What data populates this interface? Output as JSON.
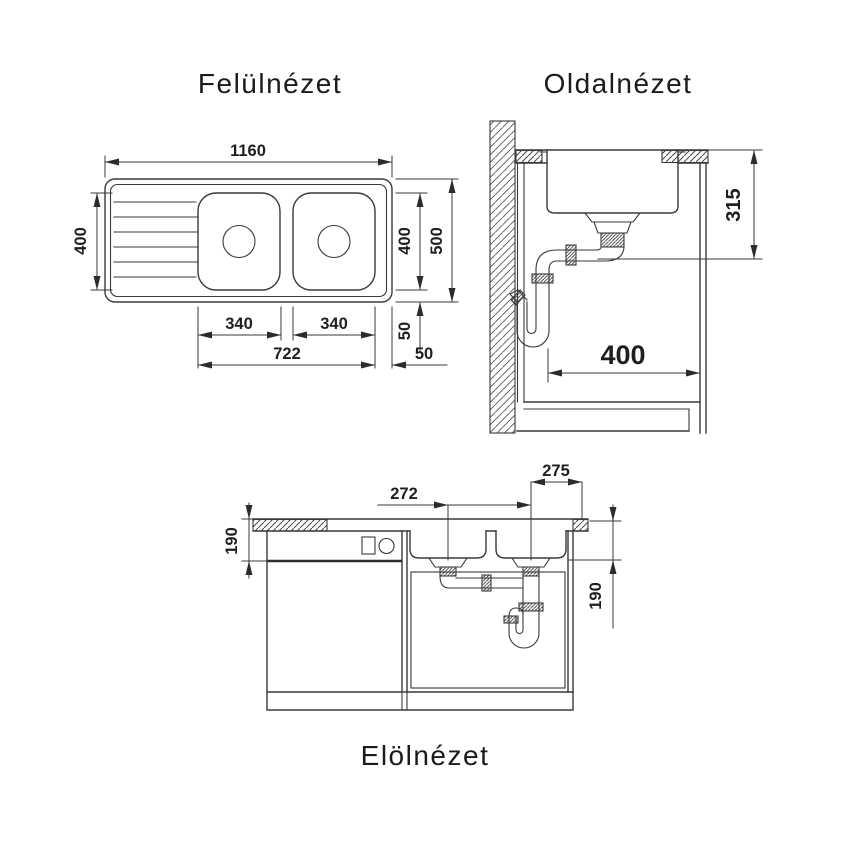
{
  "colors": {
    "background": "#ffffff",
    "lines": "#3a3a3a",
    "arrows": "#2c2c2c",
    "text": "#1f1f1f"
  },
  "views": {
    "top_view": {
      "title": "Felülnézet",
      "dimensions": {
        "overall_width": "1160",
        "drainer_depth": "400",
        "bowl_zone_depth": "400",
        "overall_depth": "500",
        "left_bowl_width": "340",
        "right_bowl_width": "340",
        "bowls_span": "722",
        "rear_offset": "50",
        "side_offset": "50"
      }
    },
    "side_view": {
      "title": "Oldalnézet",
      "dimensions": {
        "drain_assembly_height": "315",
        "cabinet_clearance": "400"
      }
    },
    "front_view": {
      "title": "Elölnézet",
      "dimensions": {
        "drain_spacing": "272",
        "drain_to_edge": "275",
        "left_bowl_depth": "190",
        "right_bowl_depth": "190"
      }
    }
  }
}
